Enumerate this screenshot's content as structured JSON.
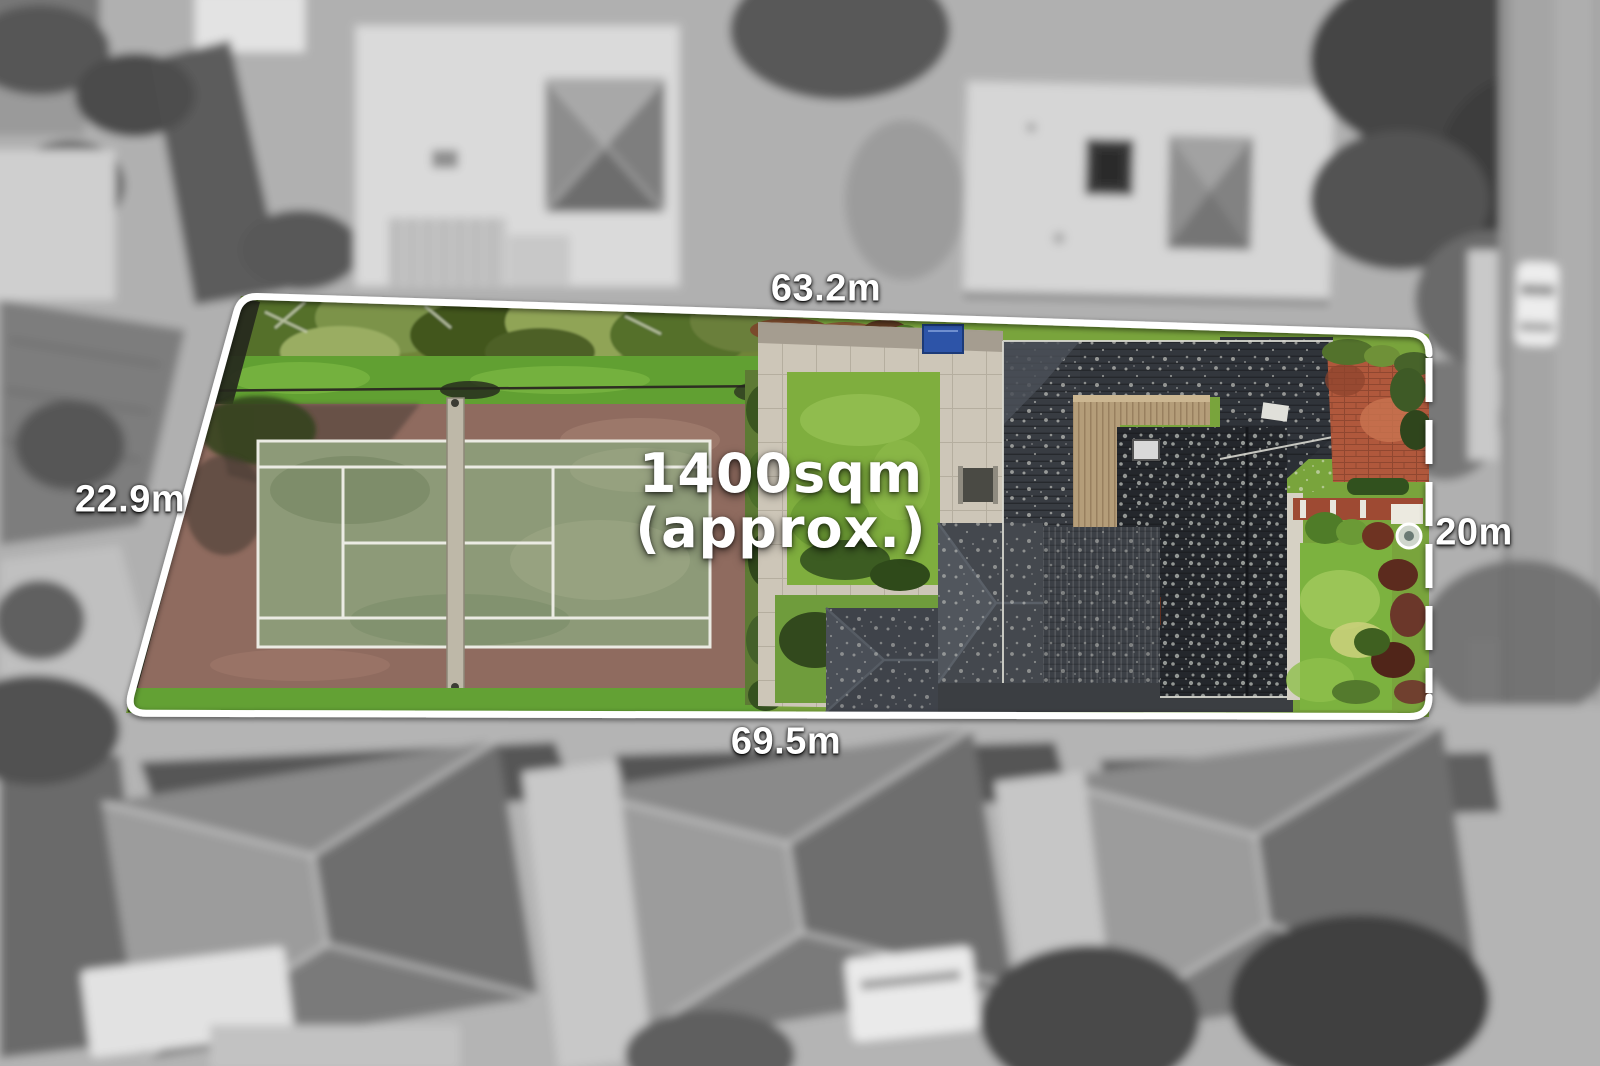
{
  "overlay": {
    "area_line1": "1400sqm",
    "area_line2": "(approx.)",
    "dim_top": "63.2m",
    "dim_left": "22.9m",
    "dim_right": "20m",
    "dim_bottom": "69.5m",
    "boundary_color": "#ffffff",
    "label_text_color": "#ffffff"
  },
  "scene": {
    "type": "aerial-property-photo",
    "inside_features": [
      "tennis-court",
      "tennis-net",
      "tree-canopy-strip",
      "lawn-patch",
      "paved-courtyard",
      "dark-tile-house-roofs",
      "tan-metal-roof",
      "rear-lawn",
      "terracotta-paving",
      "garden-beds",
      "blue-shed",
      "chimney"
    ],
    "outside_features": [
      "neighbour-building-north-west",
      "neighbour-building-north-east",
      "neighbour-hip-roof-houses-south",
      "street-east",
      "parked-car",
      "tree-canopies",
      "driveways",
      "garage"
    ],
    "palette": {
      "outside_ground": "#b4b4b4",
      "grass_green": "#6fa83a",
      "court_surface": "#8d9a78",
      "court_surround": "#8f6b5f",
      "roof_charcoal": "#24272c",
      "tan_roof": "#b49d79",
      "terracotta": "#b0583c",
      "pavement": "#cdc6b8",
      "road_gray": "#a5a5a5"
    }
  }
}
